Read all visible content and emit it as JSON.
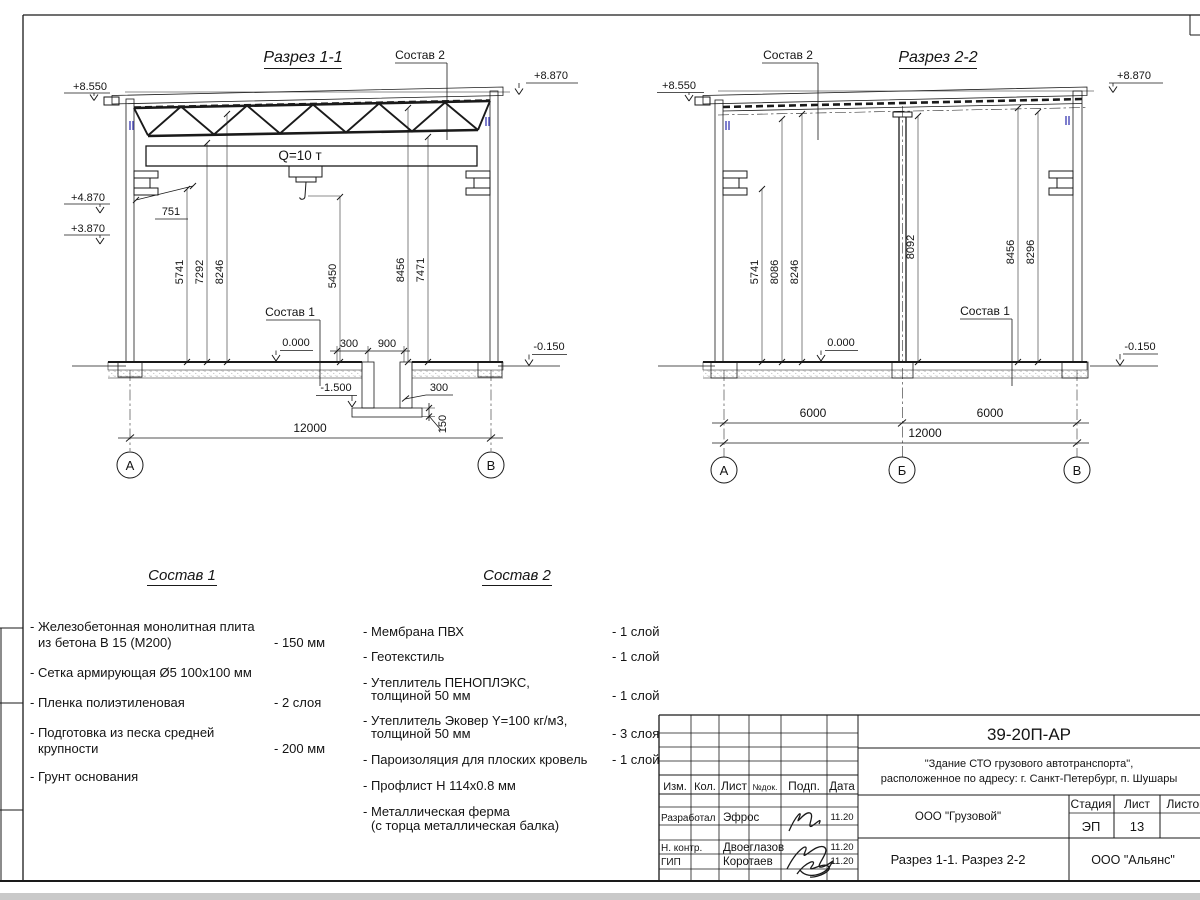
{
  "s1": {
    "title": "Разрез 1-1",
    "sostav1": "Состав 1",
    "sostav2": "Состав 2",
    "crane": "Q=10 т",
    "elev": {
      "e8550": "+8.550",
      "e8870": "+8.870",
      "e4870": "+4.870",
      "e3870": "+3.870",
      "e0": "0.000",
      "em015": "-0.150",
      "em15": "-1.500"
    },
    "dim": {
      "v1": "5741",
      "v2": "7292",
      "v3": "8246",
      "vm": "5450",
      "v4": "8456",
      "v5": "7471",
      "d751": "751",
      "d300a": "300",
      "d900": "900",
      "d300b": "300",
      "d150": "150",
      "total": "12000"
    },
    "axes": {
      "a": "А",
      "b": "В"
    }
  },
  "s2": {
    "title": "Разрез 2-2",
    "sostav1": "Состав 1",
    "sostav2": "Состав 2",
    "elev": {
      "e8550": "+8.550",
      "e8870": "+8.870",
      "e0": "0.000",
      "em015": "-0.150"
    },
    "dim": {
      "v1": "5741",
      "v2": "8086",
      "v3": "8246",
      "vm": "8092",
      "v4": "8456",
      "v5": "8296",
      "span1": "6000",
      "span2": "6000",
      "total": "12000"
    },
    "axes": {
      "a": "А",
      "b": "Б",
      "c": "В"
    }
  },
  "sostav1": {
    "title": "Состав 1",
    "i1l1": "- Железобетонная  монолитная плита",
    "i1l2": "из бетона В 15 (М200)",
    "i1v": "- 150 мм",
    "i2l1": "- Сетка армирующая Ø5 100х100 мм",
    "i3l1": "- Пленка полиэтиленовая",
    "i3v": "-  2 слоя",
    "i4l1": "- Подготовка из песка средней",
    "i4l2": "крупности",
    "i4v": "- 200 мм",
    "i5l1": "- Грунт основания"
  },
  "sostav2": {
    "title": "Состав 2",
    "i1l1": "- Мембрана ПВХ",
    "i1v": "- 1 слой",
    "i2l1": "- Геотекстиль",
    "i2v": "- 1 слой",
    "i3l1": "- Утеплитель ПЕНОПЛЭКС,",
    "i3l2": "толщиной 50 мм",
    "i3v": "- 1 слой",
    "i4l1": "- Утеплитель Эковер Y=100 кг/м3,",
    "i4l2": "толщиной 50 мм",
    "i4v": "- 3 слоя",
    "i5l1": "- Пароизоляция для плоских кровель",
    "i5v": "- 1 слой",
    "i6l1": "- Профлист Н 114х0.8 мм",
    "i7l1": "- Металлическая ферма",
    "i7l2": "(с торца металлическая балка)"
  },
  "tb": {
    "doc": "39-20П-АР",
    "obj1": "\"Здание СТО грузового автотранспорта\",",
    "obj2": "расположенное по адресу: г. Санкт-Петербург, п. Шушары",
    "h_izm": "Изм.",
    "h_kol": "Кол.",
    "h_list": "Лист",
    "h_ndok": "№док.",
    "h_podp": "Подп.",
    "h_data": "Дата",
    "r1role": "Разработал",
    "r1name": "Эфрос",
    "r1date": "11.20",
    "r2role": "Н. контр.",
    "r2name": "Двоеглазов",
    "r2date": "11.20",
    "r3role": "ГИП",
    "r3name": "Коротаев",
    "r3date": "11.20",
    "company": "ООО \"Грузовой\"",
    "stage_h": "Стадия",
    "list_h": "Лист",
    "listov_h": "Листов",
    "stage": "ЭП",
    "list": "13",
    "sheet_title": "Разрез 1-1. Разрез 2-2",
    "company2": "ООО \"Альянс\""
  }
}
